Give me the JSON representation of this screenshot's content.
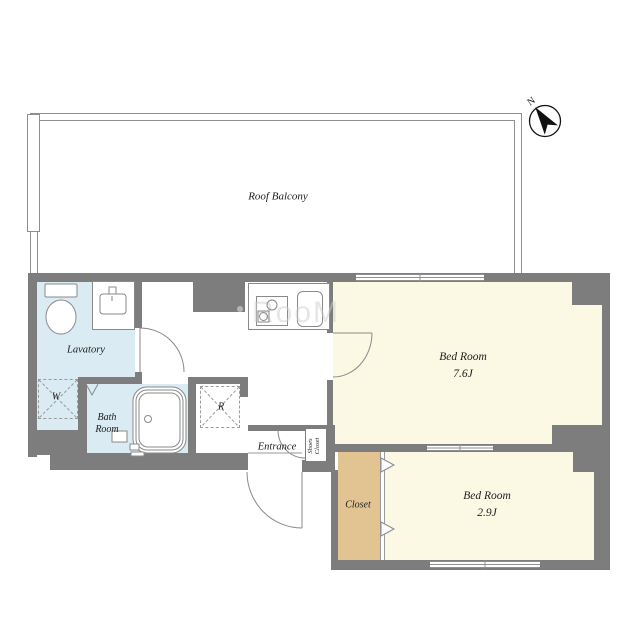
{
  "balcony": {
    "label": "Roof Balcony"
  },
  "compass": {
    "north": "N"
  },
  "rooms": {
    "lavatory": {
      "label": "Lavatory"
    },
    "washer": {
      "label": "W"
    },
    "bath": {
      "line1": "Bath",
      "line2": "Room"
    },
    "fridge": {
      "label": "R"
    },
    "entrance": {
      "label": "Entrance"
    },
    "shoes_closet": {
      "line1": "Shoes",
      "line2": "Closet"
    },
    "closet": {
      "label": "Closet"
    },
    "bedroom_large": {
      "name": "Bed Room",
      "size": "7.6J"
    },
    "bedroom_small": {
      "name": "Bed Room",
      "size": "2.9J"
    }
  },
  "watermark": {
    "text": "RooM"
  },
  "colors": {
    "wall": "#7d7d7d",
    "wet_room": "#daebf3",
    "bedroom": "#fbf9e4",
    "closet": "#e2c493",
    "fixture_line": "#8a8a8a"
  }
}
